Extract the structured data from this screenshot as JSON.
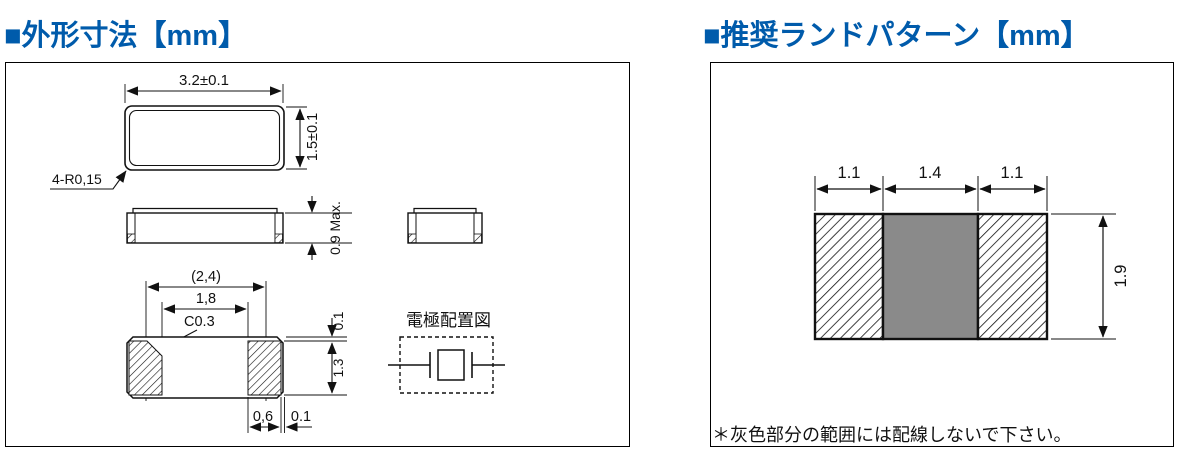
{
  "colors": {
    "accent_blue": "#005BAB",
    "keepout_gray": "#8A8A8A"
  },
  "outline_section": {
    "title": "■外形寸法【mm】",
    "top_view": {
      "width_dim": "3.2±0.1",
      "height_dim": "1.5±0.1",
      "corner_radius_label": "4-R0,15"
    },
    "side_view": {
      "max_height_dim": "0.9 Max."
    },
    "bottom_view": {
      "overall_electrode_dim": "(2,4)",
      "inner_electrode_dim": "1,8",
      "chamfer_label": "C0.3",
      "top_offset_dim": "0.1",
      "pad_height_dim": "1.3",
      "pad_width_dim": "0,6",
      "side_offset_dim": "0.1"
    },
    "electrode_diagram_label": "電極配置図"
  },
  "land_pattern_section": {
    "title": "■推奨ランドパターン【mm】",
    "left_pad_width_dim": "1.1",
    "center_width_dim": "1.4",
    "right_pad_width_dim": "1.1",
    "height_dim": "1.9",
    "note": "＊灰色部分の範囲には配線しないで下さい。"
  }
}
